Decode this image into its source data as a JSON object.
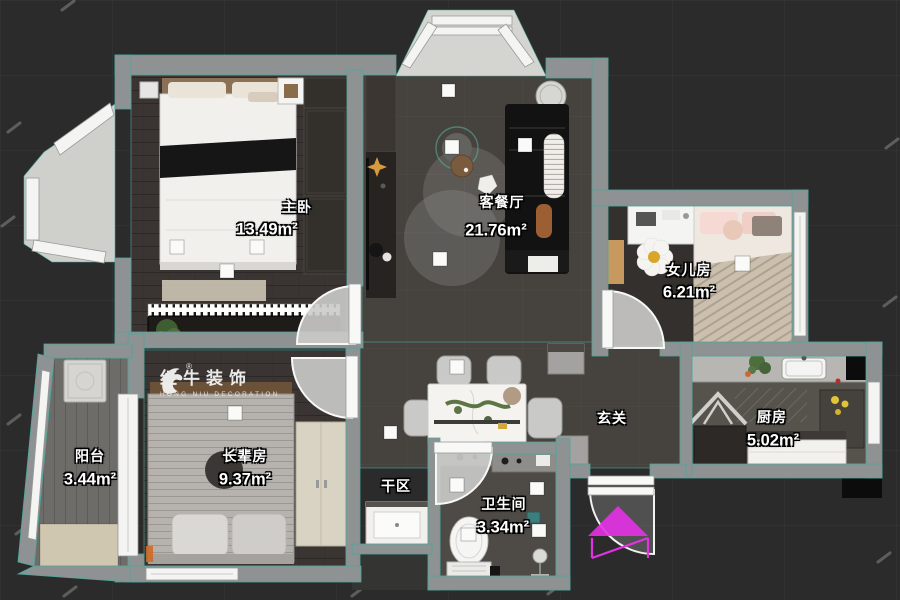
{
  "watermark": {
    "brand": "红牛装饰",
    "brand_sub": "HONG NIU DECORATION",
    "registered": "®"
  },
  "rooms": {
    "master": {
      "name": "主卧",
      "area": "13.49m²"
    },
    "living": {
      "name": "客餐厅",
      "area": "21.76m²"
    },
    "daughter": {
      "name": "女儿房",
      "area": "6.21m²"
    },
    "kitchen": {
      "name": "厨房",
      "area": "5.02m²"
    },
    "hall": {
      "name": "玄关",
      "area": ""
    },
    "dry": {
      "name": "干区",
      "area": ""
    },
    "bath": {
      "name": "卫生间",
      "area": "3.34m²"
    },
    "elder": {
      "name": "长辈房",
      "area": "9.37m²"
    },
    "balcony": {
      "name": "阳台",
      "area": "3.44m²"
    }
  },
  "colors": {
    "background": "#2b2b2b",
    "wall": "#8e9292",
    "outline_teal": "#4da89e",
    "floor_wood": "#3a3533",
    "floor_tile": "#46423e",
    "label_text": "#ffffff",
    "entry_arrow": "#e431e4",
    "accent_gold": "#d89a3e"
  },
  "icons": {
    "logo": "bull-logo-icon",
    "entry": "entry-arrow-icon"
  }
}
